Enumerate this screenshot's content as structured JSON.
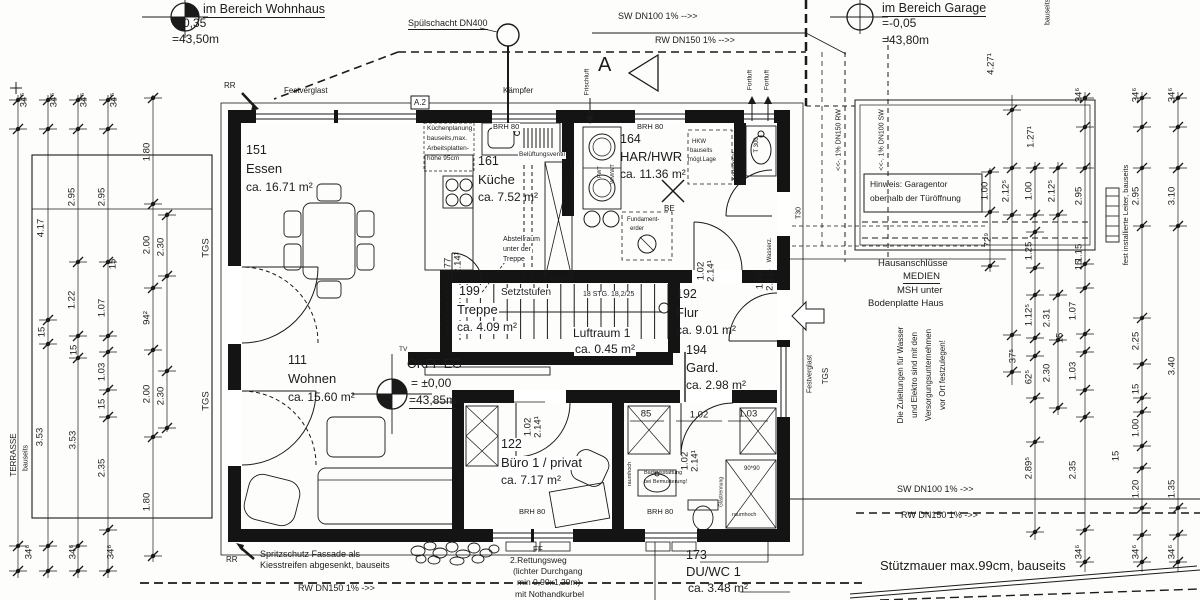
{
  "markers": {
    "wohnhaus": {
      "title": "im Bereich Wohnhaus",
      "line1": "=-0,35",
      "line2": "=43,50m"
    },
    "garage": {
      "title": "im Bereich Garage",
      "line1": "=-0,05",
      "line2": "=43,80m"
    },
    "okff": {
      "title": "OKFF EG",
      "line1": "= ±0,00",
      "line2": "=43,85m"
    }
  },
  "rooms": {
    "essen": {
      "num": "151",
      "name": "Essen",
      "area": "ca. 16.71 m²"
    },
    "kueche": {
      "num": "161",
      "name": "Küche",
      "area": "ca. 7.52 m²"
    },
    "har": {
      "num": "164",
      "name": "HAR/HWR",
      "area": "ca. 11.36 m²"
    },
    "treppe": {
      "num": "199",
      "name": "Treppe",
      "area": "ca. 4.09 m²"
    },
    "luftraum": {
      "name": "Luftraum 1",
      "area": "ca. 0.45 m²"
    },
    "flur": {
      "num": "192",
      "name": "Flur",
      "area": "ca. 9.01 m²"
    },
    "gard": {
      "num": "194",
      "name": "Gard.",
      "area": "ca. 2.98 m²"
    },
    "wohnen": {
      "num": "111",
      "name": "Wohnen",
      "area": "ca. 15.60 m²"
    },
    "buero": {
      "num": "122",
      "name": "Büro 1 / privat",
      "area": "ca. 7.17 m²"
    },
    "duwc": {
      "num": "173",
      "name": "DU/WC 1",
      "area": "ca. 3.48 m²"
    }
  },
  "stairs": {
    "setztstufen": "Setztstufen",
    "steps": "18 STG. 18,2/25"
  },
  "annotations": {
    "spuelschacht": "Spülschacht DN400",
    "sw_top": "SW DN100 1%  -->>",
    "rw_top": "RW DN150 1%  -->>",
    "sw_bottom": "SW DN100 1%  ->>",
    "rw_bottom_right": "RW DN150 1%  ->>",
    "rw_bottom_left": "RW DN150 1%   ->>",
    "festverglast": "Festverglast",
    "kaempfer": "Kämpfer",
    "rr": "RR",
    "a2": "A.2",
    "a": "A",
    "frischluft": "Frischluft",
    "fortluft": "Fortluft",
    "dn150rw": "<<-. 1% DN150 RW",
    "dn100sw": "<<-. 1% DN100 SW",
    "bauseits": "bauseits",
    "leiter": "fest installierte Leiter, bauseits",
    "belueftung": "Belüftungsventil",
    "brh80": "BRH 80",
    "kondensat": "Kondensat",
    "t300": "T 300",
    "t30": "T30",
    "wasserz": "Wasserz.",
    "fwt": "FWT",
    "wmwt": "WM/WT",
    "be": "BE",
    "tv": "TV",
    "tgs": "TGS",
    "terrasse": "TERRASSE",
    "ff": "FF",
    "glastrennung": "Glastrennung",
    "raumhoch": "raumhoch",
    "ninety": "90*90",
    "stuetzmauer": "Stützmauer max.99cm, bauseits"
  },
  "notes": {
    "kuechenplanung": [
      "Küchenplanung",
      "bauseits,max.",
      "Arbeitsplatten-",
      "höhe 95cm"
    ],
    "abstellraum": [
      "Abstellraum",
      "unter der",
      "Treppe"
    ],
    "hkw": [
      "HKW",
      "bauseits",
      "mögl.Lage"
    ],
    "hinweis": [
      "Hinweis: Garagentor",
      "oberhalb der Türöffnung"
    ],
    "hausanschluesse": [
      "Hausanschlüsse",
      "MEDIEN",
      "MSH unter",
      "Bodenplatte Haus"
    ],
    "zuleitungen": [
      "Die Zuleitungen für Wasser",
      "und Elektro sind mit den",
      "Versorgungsunternehmen",
      "vor Ort festzulegen!"
    ],
    "spritzschutz": [
      "Spritzschutz Fassade als",
      "Kiesstreifen abgesenkt, bauseits"
    ],
    "rettungsweg": [
      "2.Rettungsweg",
      "(lichter Durchgang",
      "min 0,90x1,20m)",
      "mit Nothandkurbel"
    ],
    "badausstattung": [
      "Badausstattung",
      "bei Bemusterung!"
    ],
    "fundamenterder": [
      "Fundament-",
      "erder"
    ]
  },
  "dims": [
    {
      "t": "34⁶",
      "x": 24,
      "y": 100,
      "v": 1
    },
    {
      "t": "34⁶",
      "x": 54,
      "y": 100,
      "v": 1
    },
    {
      "t": "34⁶",
      "x": 84,
      "y": 100,
      "v": 1
    },
    {
      "t": "34⁶",
      "x": 114,
      "y": 100,
      "v": 1
    },
    {
      "t": "1.80",
      "x": 147,
      "y": 152,
      "v": 1
    },
    {
      "t": "2.95",
      "x": 72,
      "y": 197,
      "v": 1
    },
    {
      "t": "2.95",
      "x": 102,
      "y": 197,
      "v": 1
    },
    {
      "t": "4.17",
      "x": 41,
      "y": 228,
      "v": 1
    },
    {
      "t": "2.00",
      "x": 147,
      "y": 245,
      "v": 1
    },
    {
      "t": "2.30",
      "x": 161,
      "y": 247,
      "v": 1
    },
    {
      "t": "15",
      "x": 113,
      "y": 264,
      "v": 1
    },
    {
      "t": "1.22",
      "x": 72,
      "y": 300,
      "v": 1
    },
    {
      "t": "1.07",
      "x": 102,
      "y": 308,
      "v": 1
    },
    {
      "t": "15",
      "x": 42,
      "y": 332,
      "v": 1
    },
    {
      "t": "15",
      "x": 74,
      "y": 350,
      "v": 1
    },
    {
      "t": "94²",
      "x": 147,
      "y": 318,
      "v": 1
    },
    {
      "t": "1.03",
      "x": 102,
      "y": 372,
      "v": 1
    },
    {
      "t": "15",
      "x": 102,
      "y": 404,
      "v": 1
    },
    {
      "t": "2.00",
      "x": 147,
      "y": 394,
      "v": 1
    },
    {
      "t": "2.30",
      "x": 161,
      "y": 396,
      "v": 1
    },
    {
      "t": "3.53",
      "x": 40,
      "y": 437,
      "v": 1
    },
    {
      "t": "3.53",
      "x": 73,
      "y": 440,
      "v": 1
    },
    {
      "t": "2.35",
      "x": 102,
      "y": 468,
      "v": 1
    },
    {
      "t": "1.80",
      "x": 147,
      "y": 502,
      "v": 1
    },
    {
      "t": "TGS",
      "x": 206,
      "y": 248,
      "v": 1
    },
    {
      "t": "TGS",
      "x": 206,
      "y": 401,
      "v": 1
    },
    {
      "t": "34⁶",
      "x": 29,
      "y": 552,
      "v": 1
    },
    {
      "t": "34⁶",
      "x": 73,
      "y": 552,
      "v": 1
    },
    {
      "t": "34⁶",
      "x": 111,
      "y": 552,
      "v": 1
    },
    {
      "t": "4.27¹",
      "x": 991,
      "y": 64,
      "v": 1
    },
    {
      "t": "1.27¹",
      "x": 1031,
      "y": 137,
      "v": 1
    },
    {
      "t": "34⁶",
      "x": 1079,
      "y": 95,
      "v": 1
    },
    {
      "t": "34⁶",
      "x": 1136,
      "y": 95,
      "v": 1
    },
    {
      "t": "34⁶",
      "x": 1172,
      "y": 95,
      "v": 1
    },
    {
      "t": "1.00",
      "x": 985,
      "y": 191,
      "v": 1
    },
    {
      "t": "2.12⁵",
      "x": 1006,
      "y": 191,
      "v": 1
    },
    {
      "t": "1.00",
      "x": 1029,
      "y": 191,
      "v": 1
    },
    {
      "t": "2.12⁵",
      "x": 1052,
      "y": 191,
      "v": 1
    },
    {
      "t": "2.95",
      "x": 1079,
      "y": 196,
      "v": 1
    },
    {
      "t": "2.95",
      "x": 1136,
      "y": 196,
      "v": 1
    },
    {
      "t": "3.10",
      "x": 1172,
      "y": 196,
      "v": 1
    },
    {
      "t": "72⁹",
      "x": 988,
      "y": 240,
      "v": 1
    },
    {
      "t": "1.25",
      "x": 1029,
      "y": 251,
      "v": 1
    },
    {
      "t": "1.15",
      "x": 1079,
      "y": 253,
      "v": 1
    },
    {
      "t": "15",
      "x": 1079,
      "y": 265,
      "v": 1
    },
    {
      "t": "1.12⁵",
      "x": 1029,
      "y": 315,
      "v": 1
    },
    {
      "t": "2.31",
      "x": 1047,
      "y": 318,
      "v": 1
    },
    {
      "t": "1.07",
      "x": 1073,
      "y": 311,
      "v": 1
    },
    {
      "t": "15",
      "x": 1060,
      "y": 338,
      "v": 1
    },
    {
      "t": "37⁵",
      "x": 1013,
      "y": 356,
      "v": 1
    },
    {
      "t": "62⁵",
      "x": 1029,
      "y": 377,
      "v": 1
    },
    {
      "t": "2.30",
      "x": 1047,
      "y": 373,
      "v": 1
    },
    {
      "t": "1.03",
      "x": 1073,
      "y": 371,
      "v": 1
    },
    {
      "t": "2.25",
      "x": 1136,
      "y": 341,
      "v": 1
    },
    {
      "t": "3.40",
      "x": 1172,
      "y": 366,
      "v": 1
    },
    {
      "t": "15",
      "x": 1136,
      "y": 389,
      "v": 1
    },
    {
      "t": "1.00",
      "x": 1136,
      "y": 428,
      "v": 1
    },
    {
      "t": "15",
      "x": 1116,
      "y": 456,
      "v": 1
    },
    {
      "t": "2.89⁵",
      "x": 1029,
      "y": 468,
      "v": 1
    },
    {
      "t": "2.35",
      "x": 1073,
      "y": 470,
      "v": 1
    },
    {
      "t": "1.20",
      "x": 1136,
      "y": 489,
      "v": 1
    },
    {
      "t": "1.35",
      "x": 1172,
      "y": 489,
      "v": 1
    },
    {
      "t": "34⁶",
      "x": 1079,
      "y": 552,
      "v": 1
    },
    {
      "t": "34⁶",
      "x": 1136,
      "y": 552,
      "v": 1
    },
    {
      "t": "34⁶",
      "x": 1172,
      "y": 552,
      "v": 1
    },
    {
      "t": "85",
      "x": 646,
      "y": 414,
      "v": 0
    },
    {
      "t": "1.02",
      "x": 699,
      "y": 415,
      "v": 0
    },
    {
      "t": "1.03",
      "x": 748,
      "y": 414,
      "v": 0
    },
    {
      "t": "1.02",
      "x": 760,
      "y": 280,
      "v": 1
    },
    {
      "t": "2.14¹",
      "x": 770,
      "y": 280,
      "v": 1
    },
    {
      "t": "1.02",
      "x": 701,
      "y": 271,
      "v": 1
    },
    {
      "t": "2.14¹",
      "x": 711,
      "y": 271,
      "v": 1
    },
    {
      "t": "1.02",
      "x": 528,
      "y": 427,
      "v": 1
    },
    {
      "t": "2.14¹",
      "x": 538,
      "y": 427,
      "v": 1
    },
    {
      "t": "1.02",
      "x": 685,
      "y": 461,
      "v": 1
    },
    {
      "t": "2.14¹",
      "x": 695,
      "y": 461,
      "v": 1
    },
    {
      "t": "77",
      "x": 448,
      "y": 263,
      "v": 1
    },
    {
      "t": "2.14¹",
      "x": 458,
      "y": 263,
      "v": 1
    }
  ],
  "colors": {
    "line": "#1a1a1a",
    "background": "#ffffff"
  }
}
